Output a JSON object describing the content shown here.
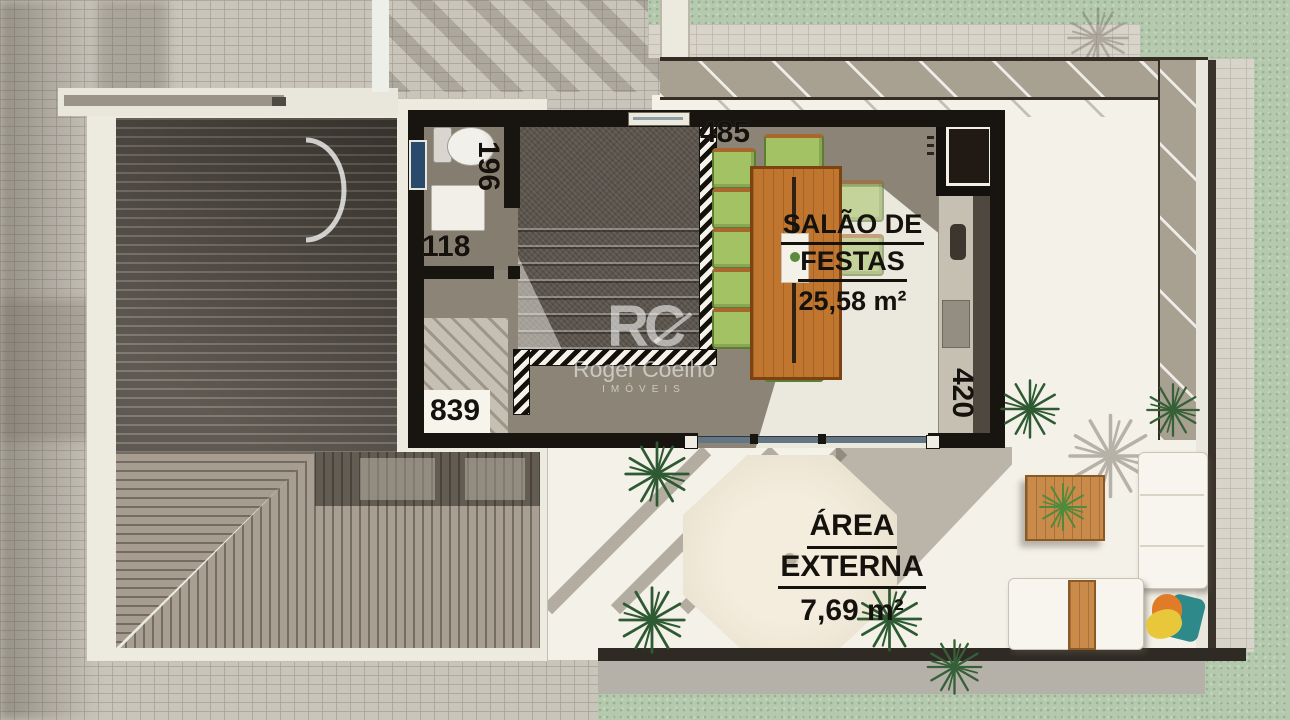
{
  "plan": {
    "rooms": {
      "salao": {
        "line1": "SALÃO DE",
        "line2": "FESTAS",
        "area": "25,58 m²"
      },
      "externa": {
        "line1": "ÁREA",
        "line2": "EXTERNA",
        "area": "7,69 m²"
      }
    },
    "dimensions": {
      "d485": "485",
      "d196": "196",
      "d118": "118",
      "d839": "839",
      "d420": "420"
    }
  },
  "watermark": {
    "logo": "RC",
    "name": "Roger Coelho",
    "subtitle": "IMÓVEIS"
  },
  "colors": {
    "wall": "#181410",
    "floor": "#8c8476",
    "terrace": "#f4f1e8",
    "grass": "#b4c9ad",
    "pavers": "#c9c5bb",
    "deck_dark": "#4c463e",
    "deck_light": "#a89f92",
    "chair_green": "#a3c263",
    "table_wood": "#c0762f",
    "window_blue": "#2a4a6b"
  }
}
